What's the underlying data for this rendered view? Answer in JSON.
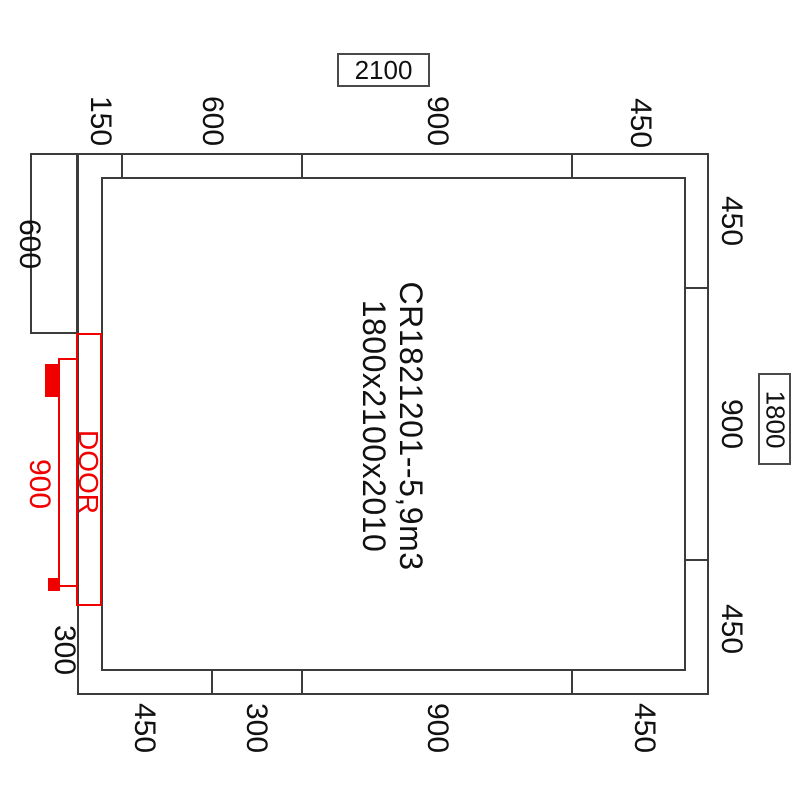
{
  "drawing": {
    "center": {
      "line1": "CR1821201--5,9m3",
      "line2": "1800x2100x2010"
    },
    "overall": {
      "width_label": "2100",
      "height_label": "1800"
    },
    "top_dims": [
      "150",
      "600",
      "900",
      "450"
    ],
    "bottom_dims": [
      "450",
      "300",
      "900",
      "450"
    ],
    "right_dims": [
      "450",
      "900",
      "450"
    ],
    "left_dims": [
      "600",
      "300"
    ],
    "door": {
      "label": "DOOR",
      "width_label": "900"
    },
    "colors": {
      "wall_line": "#3c3c3c",
      "door_accent": "#f10000",
      "text": "#111111",
      "background": "#ffffff"
    }
  }
}
